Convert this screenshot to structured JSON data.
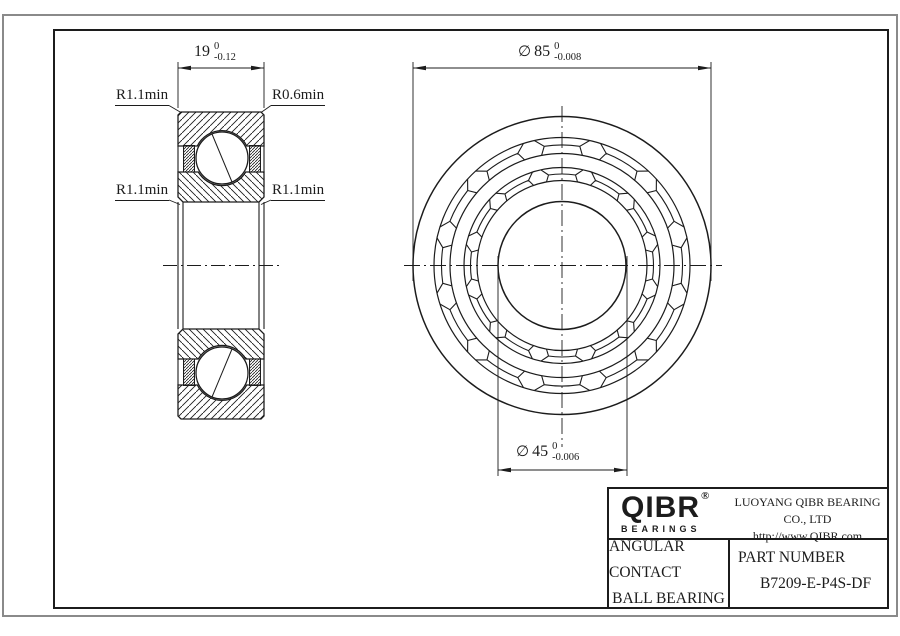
{
  "drawing": {
    "dim_width": {
      "value": "19",
      "tol_top": "0",
      "tol_bottom": "-0.12"
    },
    "dim_od": {
      "sym": "∅",
      "value": "85",
      "tol_top": "0",
      "tol_bottom": "-0.008"
    },
    "dim_bore": {
      "sym": "∅",
      "value": "45",
      "tol_top": "0",
      "tol_bottom": "-0.006"
    },
    "radius_labels": {
      "top_left": "R1.1min",
      "top_right": "R0.6min",
      "mid_left": "R1.1min",
      "mid_right": "R1.1min"
    }
  },
  "title_block": {
    "logo_text": "QIBR",
    "registered_mark": "®",
    "logo_subtext": "BEARINGS",
    "company_name": "LUOYANG QIBR BEARING CO., LTD",
    "website": "http://www.QIBR.com",
    "product_type_line1": "ANGULAR CONTACT",
    "product_type_line2": "BALL BEARING",
    "part_number_label": "PART NUMBER",
    "part_number": "B7209-E-P4S-DF"
  },
  "colors": {
    "line": "#1c1c1c",
    "outer_border": "#8a8a8a",
    "background": "#ffffff"
  }
}
